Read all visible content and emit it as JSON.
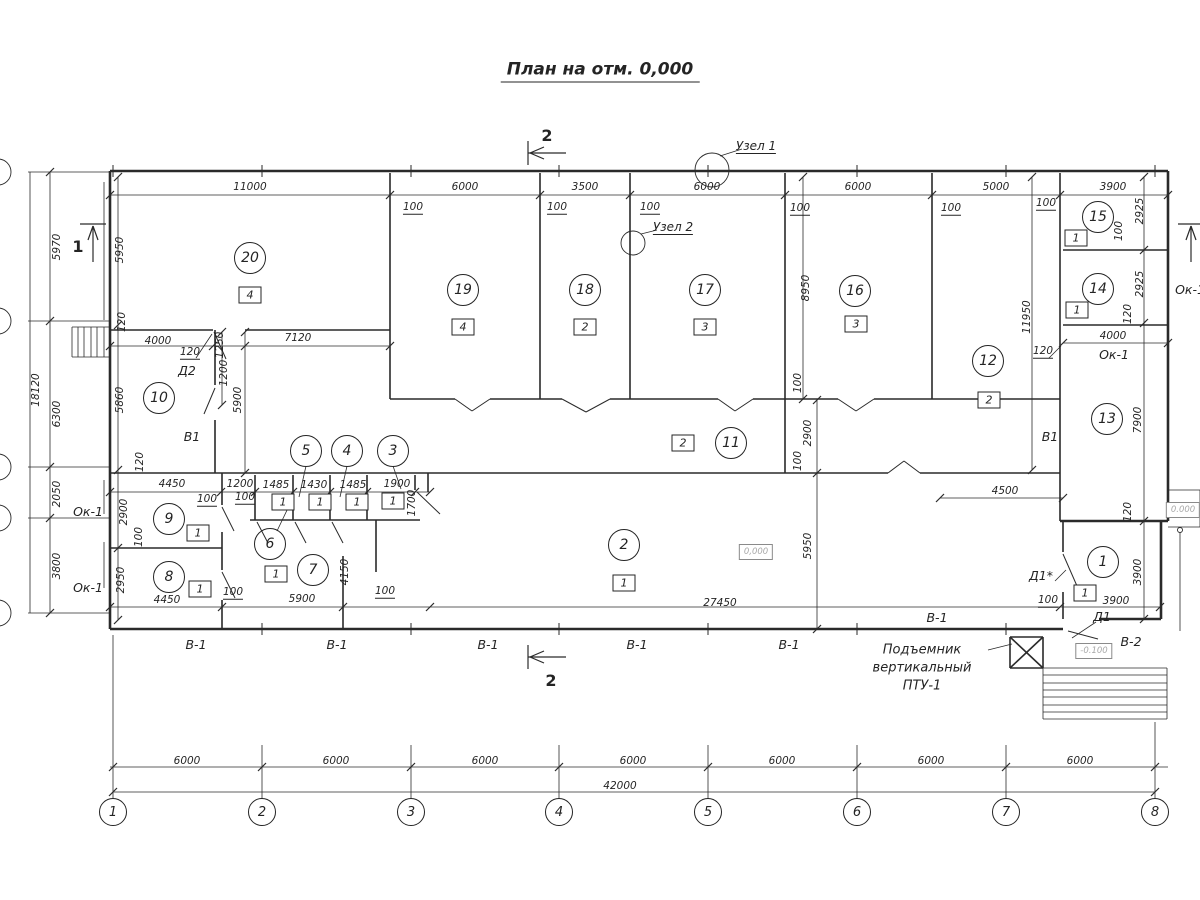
{
  "title": {
    "text": "План на отм. 0,000"
  },
  "colors": {
    "line": "#2a2a2a",
    "background": "#ffffff",
    "elevation_text": "#a8a8a8"
  },
  "section_marks": [
    {
      "label": "2",
      "x": 547,
      "y": 136
    },
    {
      "label": "2",
      "x": 551,
      "y": 681
    },
    {
      "label": "1",
      "x": 78,
      "y": 247
    }
  ],
  "detail_nodes": [
    {
      "label": "Узел 1",
      "x": 756,
      "y": 147
    },
    {
      "label": "Узел 2",
      "x": 673,
      "y": 228
    }
  ],
  "rooms": [
    {
      "num": "20",
      "x": 250,
      "y": 258,
      "cat": "4",
      "cx": 250,
      "cy": 295
    },
    {
      "num": "19",
      "x": 463,
      "y": 290,
      "cat": "4",
      "cx": 463,
      "cy": 327
    },
    {
      "num": "18",
      "x": 585,
      "y": 290,
      "cat": "2",
      "cx": 585,
      "cy": 327
    },
    {
      "num": "17",
      "x": 705,
      "y": 290,
      "cat": "3",
      "cx": 705,
      "cy": 327
    },
    {
      "num": "16",
      "x": 855,
      "y": 291,
      "cat": "3",
      "cx": 856,
      "cy": 324
    },
    {
      "num": "15",
      "x": 1098,
      "y": 217,
      "cat": "1",
      "cx": 1076,
      "cy": 238
    },
    {
      "num": "14",
      "x": 1098,
      "y": 289,
      "cat": "1",
      "cx": 1077,
      "cy": 310
    },
    {
      "num": "13",
      "x": 1107,
      "y": 419
    },
    {
      "num": "12",
      "x": 988,
      "y": 361,
      "cat": "2",
      "cx": 989,
      "cy": 400
    },
    {
      "num": "11",
      "x": 731,
      "y": 443,
      "cat": "2",
      "cx": 683,
      "cy": 443
    },
    {
      "num": "10",
      "x": 159,
      "y": 398
    },
    {
      "num": "9",
      "x": 169,
      "y": 519,
      "cat": "1",
      "cx": 198,
      "cy": 533
    },
    {
      "num": "8",
      "x": 169,
      "y": 577,
      "cat": "1",
      "cx": 200,
      "cy": 589
    },
    {
      "num": "7",
      "x": 313,
      "y": 570,
      "cat": "1",
      "cx": 276,
      "cy": 574
    },
    {
      "num": "6",
      "x": 270,
      "y": 544
    },
    {
      "num": "5",
      "x": 306,
      "y": 451
    },
    {
      "num": "4",
      "x": 347,
      "y": 451
    },
    {
      "num": "3",
      "x": 393,
      "y": 451
    },
    {
      "num": "2",
      "x": 624,
      "y": 545,
      "cat": "1",
      "cx": 624,
      "cy": 583
    },
    {
      "num": "1",
      "x": 1103,
      "y": 562,
      "cat": "1",
      "cx": 1085,
      "cy": 593
    }
  ],
  "fixture_boxes": [
    {
      "label": "1",
      "x": 283,
      "y": 502
    },
    {
      "label": "1",
      "x": 320,
      "y": 502
    },
    {
      "label": "1",
      "x": 357,
      "y": 502
    },
    {
      "label": "1",
      "x": 393,
      "y": 501
    }
  ],
  "dimensions": [
    {
      "t": "11000",
      "x": 250,
      "y": 187
    },
    {
      "t": "6000",
      "x": 465,
      "y": 187
    },
    {
      "t": "3500",
      "x": 585,
      "y": 187
    },
    {
      "t": "6000",
      "x": 707,
      "y": 187
    },
    {
      "t": "6000",
      "x": 858,
      "y": 187
    },
    {
      "t": "5000",
      "x": 996,
      "y": 187
    },
    {
      "t": "3900",
      "x": 1113,
      "y": 187
    },
    {
      "t": "100",
      "x": 413,
      "y": 208,
      "u": 1
    },
    {
      "t": "100",
      "x": 557,
      "y": 208,
      "u": 1
    },
    {
      "t": "100",
      "x": 650,
      "y": 208,
      "u": 1
    },
    {
      "t": "100",
      "x": 800,
      "y": 209,
      "u": 1
    },
    {
      "t": "100",
      "x": 951,
      "y": 209,
      "u": 1
    },
    {
      "t": "100",
      "x": 1046,
      "y": 204,
      "u": 1
    },
    {
      "t": "2925",
      "x": 1140,
      "y": 211,
      "r": 1
    },
    {
      "t": "100",
      "x": 1119,
      "y": 231,
      "r": 1
    },
    {
      "t": "2925",
      "x": 1140,
      "y": 284,
      "r": 1
    },
    {
      "t": "120",
      "x": 1128,
      "y": 314,
      "r": 1
    },
    {
      "t": "4000",
      "x": 1113,
      "y": 336
    },
    {
      "t": "120",
      "x": 1043,
      "y": 352,
      "u": 1
    },
    {
      "t": "11950",
      "x": 1027,
      "y": 317,
      "r": 1
    },
    {
      "t": "8950",
      "x": 806,
      "y": 288,
      "r": 1
    },
    {
      "t": "100",
      "x": 798,
      "y": 383,
      "r": 1
    },
    {
      "t": "2900",
      "x": 808,
      "y": 433,
      "r": 1
    },
    {
      "t": "100",
      "x": 798,
      "y": 461,
      "r": 1
    },
    {
      "t": "7900",
      "x": 1138,
      "y": 420,
      "r": 1
    },
    {
      "t": "120",
      "x": 1128,
      "y": 512,
      "r": 1
    },
    {
      "t": "4500",
      "x": 1005,
      "y": 491
    },
    {
      "t": "5950",
      "x": 808,
      "y": 546,
      "r": 1
    },
    {
      "t": "3900",
      "x": 1138,
      "y": 572,
      "r": 1
    },
    {
      "t": "3900",
      "x": 1116,
      "y": 601
    },
    {
      "t": "100",
      "x": 1048,
      "y": 601,
      "u": 1
    },
    {
      "t": "5970",
      "x": 57,
      "y": 247,
      "r": 1
    },
    {
      "t": "6300",
      "x": 57,
      "y": 414,
      "r": 1
    },
    {
      "t": "2050",
      "x": 57,
      "y": 494,
      "r": 1
    },
    {
      "t": "3800",
      "x": 57,
      "y": 566,
      "r": 1
    },
    {
      "t": "18120",
      "x": 36,
      "y": 390,
      "r": 1
    },
    {
      "t": "5950",
      "x": 120,
      "y": 250,
      "r": 1
    },
    {
      "t": "120",
      "x": 122,
      "y": 322,
      "r": 1
    },
    {
      "t": "5860",
      "x": 120,
      "y": 400,
      "r": 1
    },
    {
      "t": "120",
      "x": 140,
      "y": 462,
      "r": 1
    },
    {
      "t": "2900",
      "x": 124,
      "y": 512,
      "r": 1
    },
    {
      "t": "100",
      "x": 139,
      "y": 537,
      "r": 1
    },
    {
      "t": "2950",
      "x": 121,
      "y": 580,
      "r": 1
    },
    {
      "t": "4000",
      "x": 158,
      "y": 341
    },
    {
      "t": "120",
      "x": 190,
      "y": 353,
      "u": 1
    },
    {
      "t": "1250",
      "x": 220,
      "y": 345,
      "r": 1
    },
    {
      "t": "1200",
      "x": 224,
      "y": 373,
      "r": 1
    },
    {
      "t": "5900",
      "x": 238,
      "y": 400,
      "r": 1
    },
    {
      "t": "7120",
      "x": 298,
      "y": 338
    },
    {
      "t": "4450",
      "x": 172,
      "y": 484
    },
    {
      "t": "1200",
      "x": 240,
      "y": 484
    },
    {
      "t": "1485",
      "x": 276,
      "y": 485
    },
    {
      "t": "1430",
      "x": 314,
      "y": 485
    },
    {
      "t": "1485",
      "x": 353,
      "y": 485
    },
    {
      "t": "1900",
      "x": 397,
      "y": 484
    },
    {
      "t": "1700",
      "x": 412,
      "y": 503,
      "r": 1
    },
    {
      "t": "100",
      "x": 207,
      "y": 500,
      "u": 1
    },
    {
      "t": "100",
      "x": 245,
      "y": 498,
      "u": 1
    },
    {
      "t": "4450",
      "x": 167,
      "y": 600
    },
    {
      "t": "100",
      "x": 233,
      "y": 593,
      "u": 1
    },
    {
      "t": "5900",
      "x": 302,
      "y": 599
    },
    {
      "t": "100",
      "x": 385,
      "y": 592,
      "u": 1
    },
    {
      "t": "4150",
      "x": 345,
      "y": 572,
      "r": 1
    },
    {
      "t": "27450",
      "x": 720,
      "y": 603
    }
  ],
  "opening_labels": [
    {
      "t": "Д2",
      "x": 187,
      "y": 371
    },
    {
      "t": "В1",
      "x": 192,
      "y": 437
    },
    {
      "t": "В1",
      "x": 1050,
      "y": 437
    },
    {
      "t": "Д1*",
      "x": 1041,
      "y": 576
    },
    {
      "t": "Д1",
      "x": 1102,
      "y": 617
    },
    {
      "t": "В-2",
      "x": 1131,
      "y": 642
    },
    {
      "t": "В-1",
      "x": 196,
      "y": 645
    },
    {
      "t": "В-1",
      "x": 337,
      "y": 645
    },
    {
      "t": "В-1",
      "x": 488,
      "y": 645
    },
    {
      "t": "В-1",
      "x": 637,
      "y": 645
    },
    {
      "t": "В-1",
      "x": 789,
      "y": 645
    },
    {
      "t": "В-1",
      "x": 937,
      "y": 618
    },
    {
      "t": "Ок-1",
      "x": 88,
      "y": 512
    },
    {
      "t": "Ок-1",
      "x": 88,
      "y": 588
    },
    {
      "t": "Ок-1",
      "x": 1114,
      "y": 355
    },
    {
      "t": "Ок-1",
      "x": 1190,
      "y": 290
    }
  ],
  "elevation_marks": [
    {
      "text": "0,000",
      "x": 756,
      "y": 552
    },
    {
      "text": "0.000",
      "x": 1183,
      "y": 510
    },
    {
      "text": "-0.100",
      "x": 1094,
      "y": 651
    }
  ],
  "equipment_note": {
    "lines": [
      {
        "text": "Подъемник"
      },
      {
        "text": "вертикальный"
      },
      {
        "text": "ПТУ-1"
      }
    ],
    "x": 888,
    "y": 650
  },
  "grid_axes": {
    "bottom": {
      "y": 812,
      "bubbles": [
        {
          "label": "1",
          "x": 113
        },
        {
          "label": "2",
          "x": 262
        },
        {
          "label": "3",
          "x": 411
        },
        {
          "label": "4",
          "x": 559
        },
        {
          "label": "5",
          "x": 708
        },
        {
          "label": "6",
          "x": 857
        },
        {
          "label": "7",
          "x": 1006
        },
        {
          "label": "8",
          "x": 1155
        }
      ],
      "spacing_dims": [
        {
          "t": "6000",
          "x": 187
        },
        {
          "t": "6000",
          "x": 336
        },
        {
          "t": "6000",
          "x": 485
        },
        {
          "t": "6000",
          "x": 633
        },
        {
          "t": "6000",
          "x": 782
        },
        {
          "t": "6000",
          "x": 931
        },
        {
          "t": "6000",
          "x": 1080
        }
      ],
      "dims_y": 761,
      "total": {
        "t": "42000",
        "x": 620,
        "y": 786
      }
    }
  }
}
